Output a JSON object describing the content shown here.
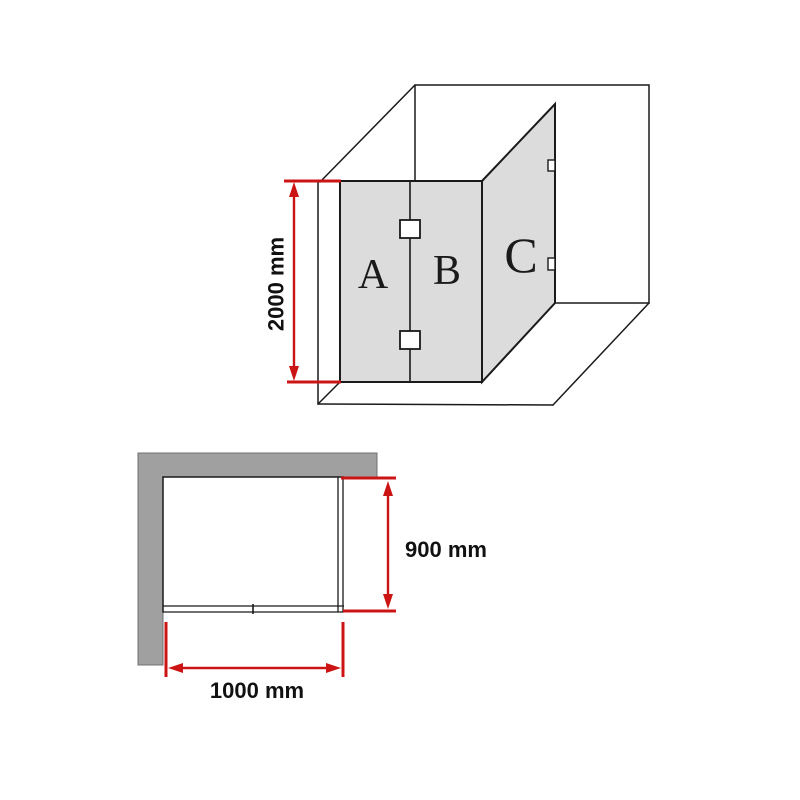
{
  "colors": {
    "background": "#ffffff",
    "glass_panel": "#dcdcdc",
    "wall": "#a0a0a0",
    "wall_edge": "#707070",
    "outline": "#1a1a1a",
    "dimension_red": "#cc1414",
    "hinge_fill": "#ffffff"
  },
  "perspective_view": {
    "panel_labels": {
      "left": "A",
      "middle": "B",
      "side": "C"
    },
    "height_dimension": "2000 mm"
  },
  "plan_view": {
    "depth_dimension": "900 mm",
    "width_dimension": "1000 mm"
  }
}
